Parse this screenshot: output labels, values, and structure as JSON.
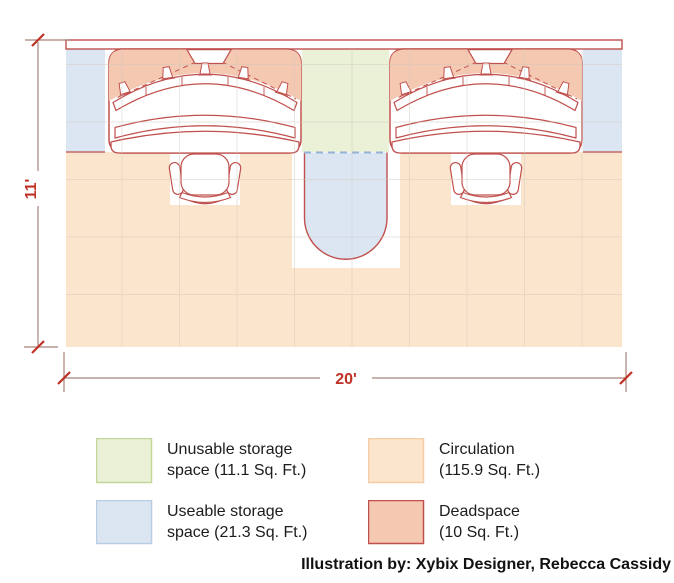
{
  "plan": {
    "height_label": "11'",
    "width_label": "20'"
  },
  "legend": {
    "items": [
      {
        "id": "unusable-storage",
        "line1": "Unusable storage",
        "line2": "space (11.1 Sq. Ft.)",
        "color": "#ebf1d7",
        "border": "#c4d79b"
      },
      {
        "id": "circulation",
        "line1": "Circulation",
        "line2": "(115.9 Sq. Ft.)",
        "color": "#fce5cd",
        "border": "#f3cda4"
      },
      {
        "id": "useable-storage",
        "line1": "Useable storage",
        "line2": "space (21.3 Sq. Ft.)",
        "color": "#dce6f2",
        "border": "#b8cce4"
      },
      {
        "id": "deadspace",
        "line1": "Deadspace",
        "line2": "(10 Sq. Ft.)",
        "color": "#f5c8b2",
        "border": "#c0504d"
      }
    ]
  },
  "attribution": "Illustration by: Xybix Designer, Rebecca Cassidy",
  "colors": {
    "outline_red": "#c0504d",
    "dimension_red": "#bf3124",
    "dimension_line": "#a8827c",
    "dashed_blue": "#95b3d7",
    "grid": "#cfc8bc"
  }
}
